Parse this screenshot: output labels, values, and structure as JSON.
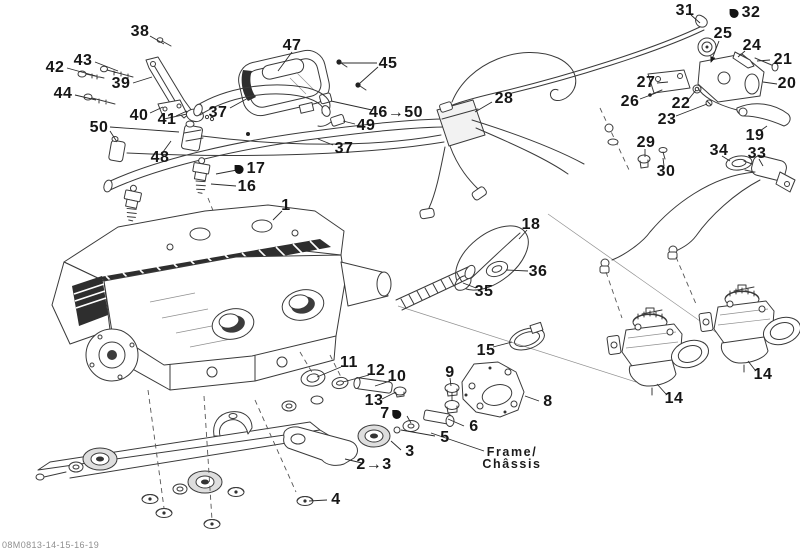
{
  "document": {
    "code": "08M0813-14-15-16-19",
    "frame_label": {
      "line1": "Frame/",
      "line2": "Châssis"
    }
  },
  "diagram": {
    "description": "Exploded parts view of engine and engine support with numbered callouts",
    "colors": {
      "background": "#ffffff",
      "line_art": "#3a3a3a",
      "label_text": "#161616"
    },
    "callouts": [
      {
        "label": "38",
        "x": 140,
        "y": 32
      },
      {
        "label": "42",
        "x": 55,
        "y": 68
      },
      {
        "label": "43",
        "x": 83,
        "y": 61
      },
      {
        "label": "44",
        "x": 63,
        "y": 94
      },
      {
        "label": "39",
        "x": 121,
        "y": 84
      },
      {
        "label": "40",
        "x": 139,
        "y": 116
      },
      {
        "label": "41",
        "x": 167,
        "y": 120
      },
      {
        "label": "47",
        "x": 292,
        "y": 46
      },
      {
        "label": "45",
        "x": 388,
        "y": 64
      },
      {
        "label": "46→50",
        "x": 396,
        "y": 113
      },
      {
        "label": "49",
        "x": 366,
        "y": 126
      },
      {
        "label": "37",
        "x": 218,
        "y": 113
      },
      {
        "label": "37",
        "x": 344,
        "y": 149
      },
      {
        "label": "50",
        "x": 99,
        "y": 128
      },
      {
        "label": "48",
        "x": 160,
        "y": 158
      },
      {
        "label": "17",
        "x": 250,
        "y": 169,
        "symbol": "before"
      },
      {
        "label": "16",
        "x": 247,
        "y": 187
      },
      {
        "label": "1",
        "x": 286,
        "y": 206
      },
      {
        "label": "28",
        "x": 504,
        "y": 99
      },
      {
        "label": "31",
        "x": 685,
        "y": 11
      },
      {
        "label": "32",
        "x": 745,
        "y": 13,
        "symbol": "before"
      },
      {
        "label": "25",
        "x": 723,
        "y": 34
      },
      {
        "label": "24",
        "x": 752,
        "y": 46
      },
      {
        "label": "21",
        "x": 783,
        "y": 60
      },
      {
        "label": "27",
        "x": 646,
        "y": 83
      },
      {
        "label": "26",
        "x": 630,
        "y": 102
      },
      {
        "label": "22",
        "x": 681,
        "y": 104
      },
      {
        "label": "23",
        "x": 667,
        "y": 120
      },
      {
        "label": "20",
        "x": 787,
        "y": 84
      },
      {
        "label": "29",
        "x": 646,
        "y": 143
      },
      {
        "label": "30",
        "x": 666,
        "y": 172
      },
      {
        "label": "34",
        "x": 719,
        "y": 151
      },
      {
        "label": "33",
        "x": 757,
        "y": 154
      },
      {
        "label": "19",
        "x": 755,
        "y": 136
      },
      {
        "label": "18",
        "x": 531,
        "y": 225
      },
      {
        "label": "36",
        "x": 538,
        "y": 272
      },
      {
        "label": "35",
        "x": 484,
        "y": 292
      },
      {
        "label": "15",
        "x": 486,
        "y": 351
      },
      {
        "label": "11",
        "x": 349,
        "y": 363
      },
      {
        "label": "12",
        "x": 376,
        "y": 371
      },
      {
        "label": "10",
        "x": 397,
        "y": 377
      },
      {
        "label": "9",
        "x": 450,
        "y": 373
      },
      {
        "label": "13",
        "x": 374,
        "y": 401
      },
      {
        "label": "7",
        "x": 391,
        "y": 414,
        "symbol": "after"
      },
      {
        "label": "8",
        "x": 548,
        "y": 402
      },
      {
        "label": "6",
        "x": 474,
        "y": 427
      },
      {
        "label": "5",
        "x": 445,
        "y": 438
      },
      {
        "label": "3",
        "x": 410,
        "y": 452
      },
      {
        "label": "2→3",
        "x": 374,
        "y": 465
      },
      {
        "label": "4",
        "x": 336,
        "y": 500
      },
      {
        "label": "14",
        "x": 674,
        "y": 399
      },
      {
        "label": "14",
        "x": 763,
        "y": 375
      }
    ]
  }
}
